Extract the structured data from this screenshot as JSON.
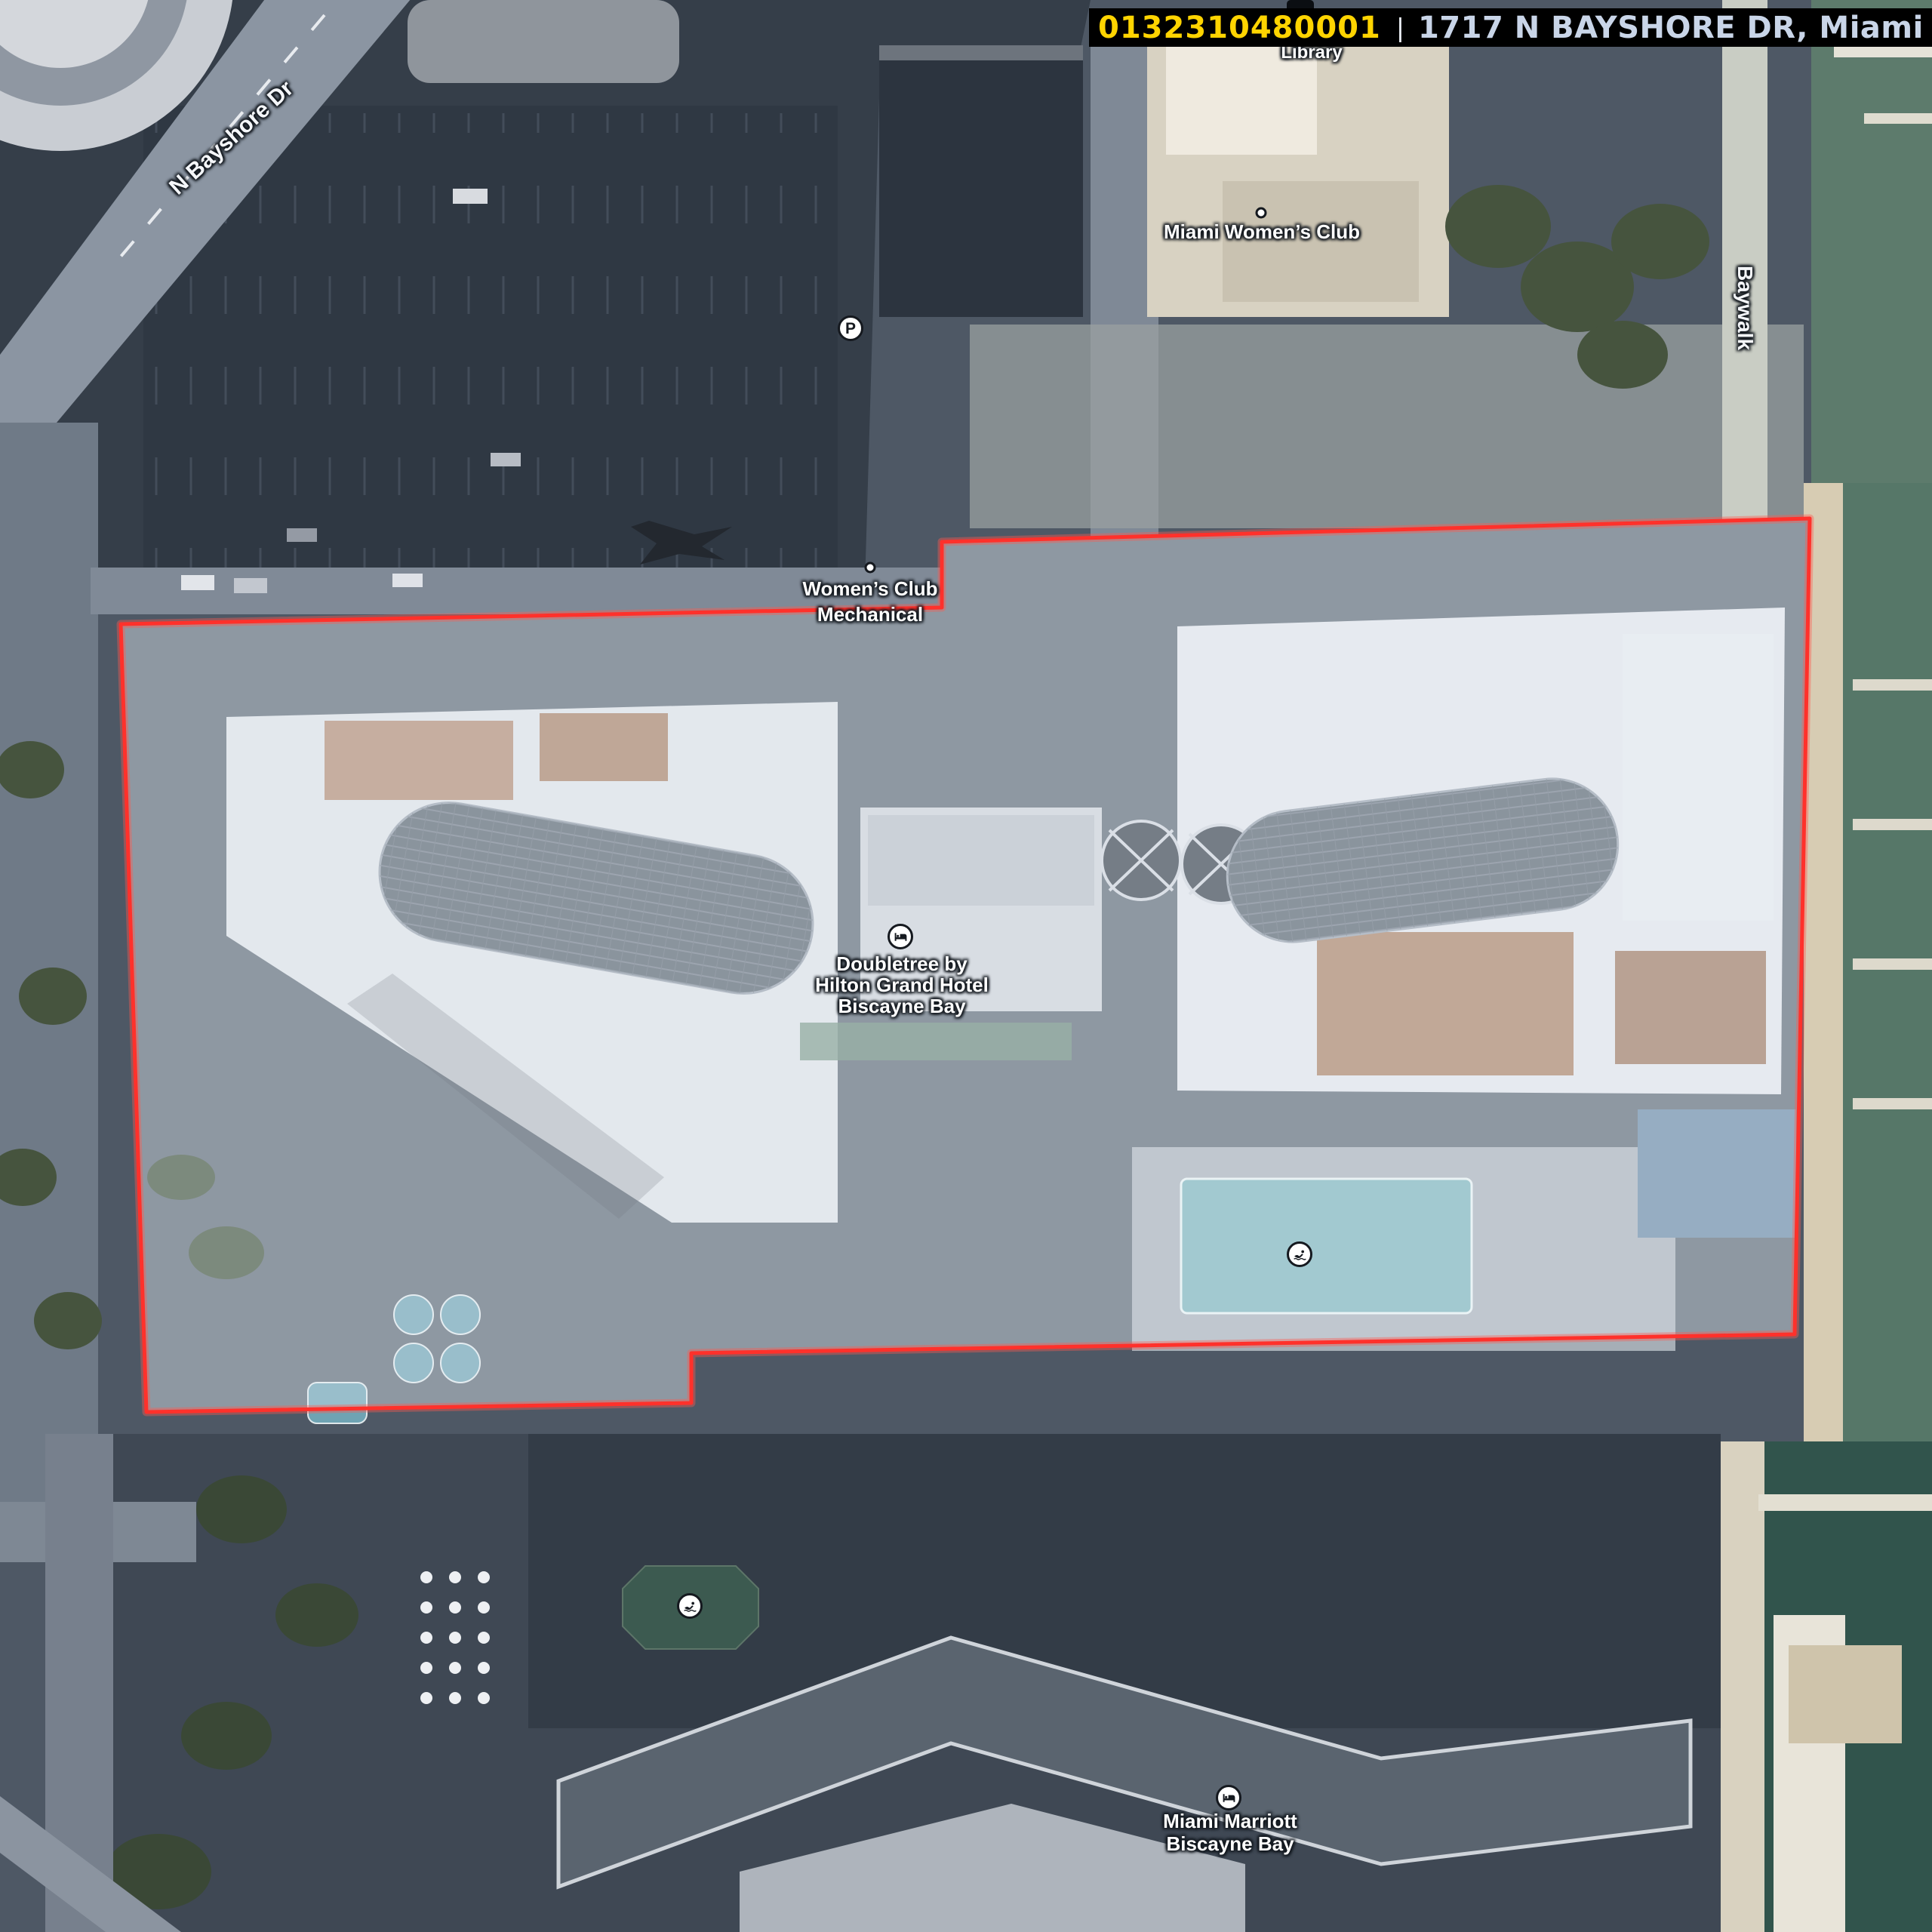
{
  "header": {
    "parcel_id": "0132310480001",
    "separator": "|",
    "address": "1717 N BAYSHORE DR, Miami",
    "parcel_id_color": "#ffd400",
    "address_color": "#c9d5e8",
    "bar_color": "#000000"
  },
  "map": {
    "type": "aerial-imagery-with-parcel-overlay",
    "street_labels": [
      {
        "text": "N Bayshore Dr"
      },
      {
        "text": "Baywalk"
      }
    ],
    "poi_labels": {
      "library": {
        "text": "Library"
      },
      "miami_womens_club": {
        "text": "Miami Women’s Club"
      },
      "womens_club_mechanical": {
        "line1": "Women’s Club",
        "line2": "Mechanical"
      },
      "doubletree": {
        "line1": "Doubletree by",
        "line2": "Hilton Grand Hotel",
        "line3": "Biscayne Bay"
      },
      "miami_marriott": {
        "line1": "Miami Marriott",
        "line2": "Biscayne Bay"
      }
    },
    "icons": {
      "parking": {
        "glyph": "P"
      },
      "lodging_doubletree": {
        "type": "bed"
      },
      "lodging_marriott": {
        "type": "bed"
      },
      "pool_doubletree": {
        "type": "swimmer"
      },
      "pool_marriott": {
        "type": "swimmer"
      },
      "library": {
        "type": "institution"
      }
    },
    "parcel": {
      "outline_color": "#ff312b",
      "fill": "rgba(240,245,252,0.33)",
      "points": [
        [
          160,
          827
        ],
        [
          1248,
          805
        ],
        [
          1248,
          718
        ],
        [
          2398,
          687
        ],
        [
          2378,
          1768
        ],
        [
          916,
          1793
        ],
        [
          916,
          1859
        ],
        [
          194,
          1871
        ]
      ]
    },
    "feature_colors": {
      "shadowed_blocks": "#353e49",
      "roads": "#8b95a2",
      "bay_water": "#567768",
      "marina_water": "#31544c",
      "pool_water": "#7db4bb",
      "pond_water": "#3c5a50",
      "sand_walk": "#d7ccb3",
      "trees": "#46543e",
      "white_roofs": "#dfe3e8",
      "terracotta_roofs": "#b28b74",
      "glass_towers": "#59646f"
    }
  }
}
